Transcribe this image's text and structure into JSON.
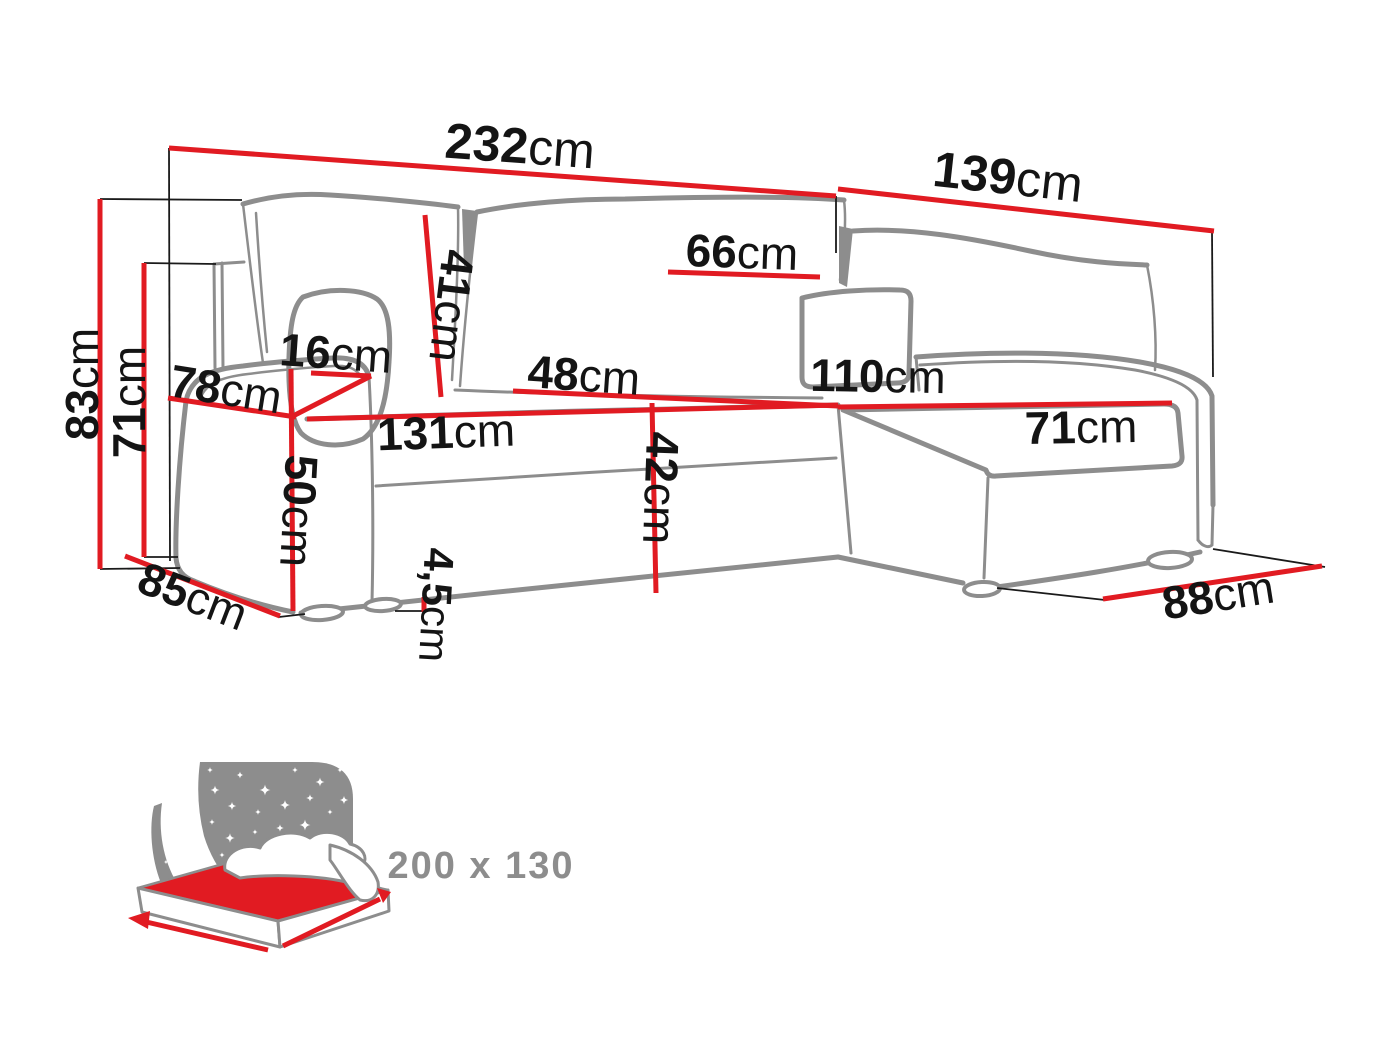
{
  "colors": {
    "accent": "#e11b22",
    "outline": "#8d8d8d",
    "thin": "#1a1a1a",
    "label": "#141414"
  },
  "diagram": {
    "title": "corner-sofa-dimensions",
    "dimensions": [
      {
        "id": "total-width",
        "value": "232",
        "unit": "cm"
      },
      {
        "id": "chaise-depth",
        "value": "139",
        "unit": "cm"
      },
      {
        "id": "back-cushion-width",
        "value": "66",
        "unit": "cm"
      },
      {
        "id": "back-cushion-height",
        "value": "41",
        "unit": "cm"
      },
      {
        "id": "armrest-width",
        "value": "16",
        "unit": "cm"
      },
      {
        "id": "armrest-depth",
        "value": "78",
        "unit": "cm"
      },
      {
        "id": "armrest-front-height",
        "value": "50",
        "unit": "cm"
      },
      {
        "id": "seat-depth",
        "value": "48",
        "unit": "cm"
      },
      {
        "id": "chaise-length",
        "value": "110",
        "unit": "cm"
      },
      {
        "id": "seat-width",
        "value": "131",
        "unit": "cm"
      },
      {
        "id": "chaise-seat-width",
        "value": "71",
        "unit": "cm"
      },
      {
        "id": "seat-height",
        "value": "42",
        "unit": "cm"
      },
      {
        "id": "leg-height",
        "value": "4,5",
        "unit": "cm"
      },
      {
        "id": "depth-left",
        "value": "85",
        "unit": "cm"
      },
      {
        "id": "depth-right",
        "value": "88",
        "unit": "cm"
      },
      {
        "id": "total-height",
        "value": "83",
        "unit": "cm"
      },
      {
        "id": "backrest-height",
        "value": "71",
        "unit": "cm"
      }
    ],
    "sleeping_area": {
      "label": "200 x 130"
    }
  }
}
